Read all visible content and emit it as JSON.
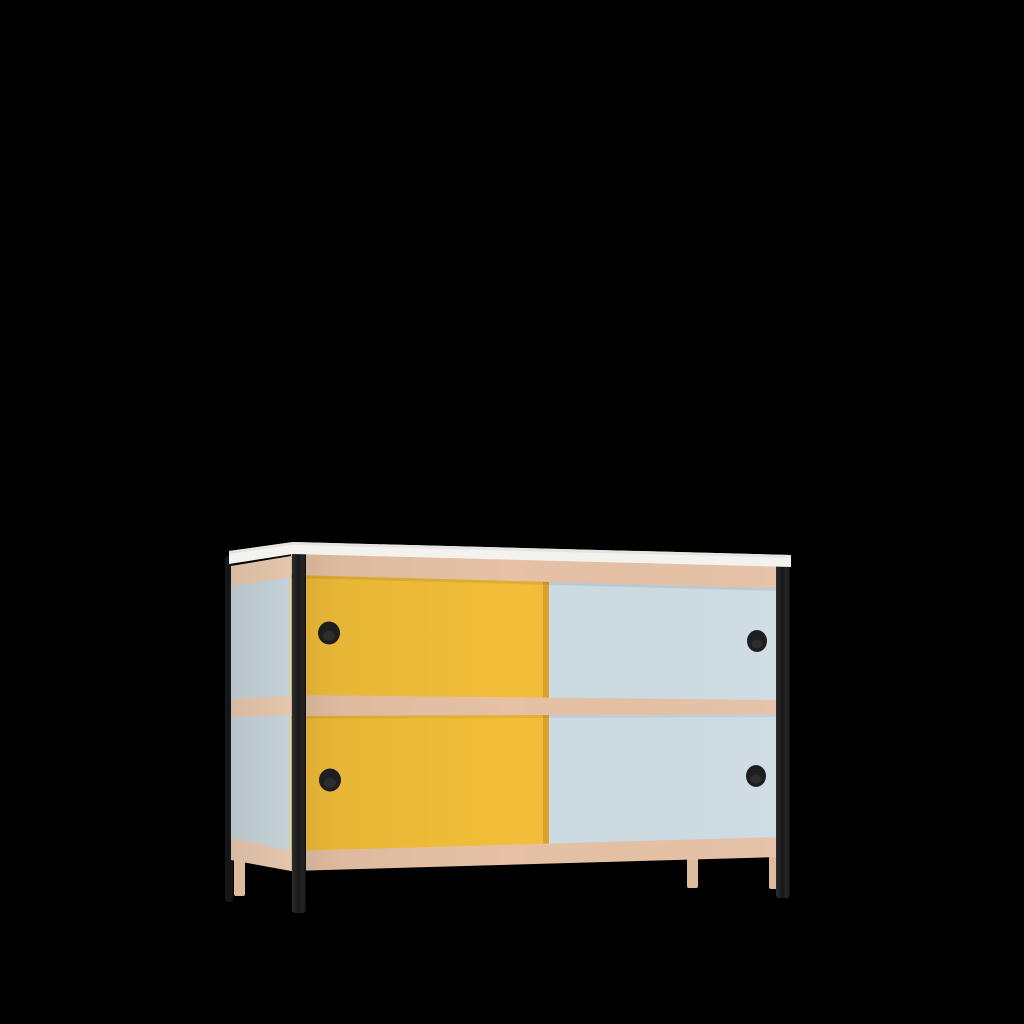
{
  "scene": {
    "description": "3D product render of a two-tier sideboard cabinet with sliding doors, centered on a plain black background",
    "object": "sideboard-cabinet",
    "view": "front-left three-quarter perspective",
    "background_color": "#000000"
  },
  "colors": {
    "background": "#000000",
    "worktop_white": "#F3F2EF",
    "worktop_top_shade": "#E6E4E1",
    "frame_wood": "#E6C1A5",
    "frame_wood_side": "#EACAB0",
    "wood_leg": "#DFBB9E",
    "door_yellow": "#F2BE39",
    "door_yellow_edge": "#DCA22C",
    "door_blue": "#CEDCE3",
    "door_blue_side": "#C8D5DB",
    "steel_leg_black": "#161616",
    "handle_black": "#1E1E1E"
  },
  "furniture": {
    "tiers": 2,
    "doors": [
      {
        "tier": "upper",
        "side": "left",
        "color": "yellow"
      },
      {
        "tier": "upper",
        "side": "right",
        "color": "light-blue"
      },
      {
        "tier": "lower",
        "side": "left",
        "color": "yellow"
      },
      {
        "tier": "lower",
        "side": "right",
        "color": "light-blue"
      }
    ],
    "handles": {
      "count": 4,
      "shape": "round-recessed",
      "color": "black"
    },
    "legs": {
      "steel_black_count": 3,
      "wood_count": 3
    },
    "frame": "wood rails at top, middle and bottom with a white worktop",
    "side_panel": "light-blue with wood rails"
  }
}
